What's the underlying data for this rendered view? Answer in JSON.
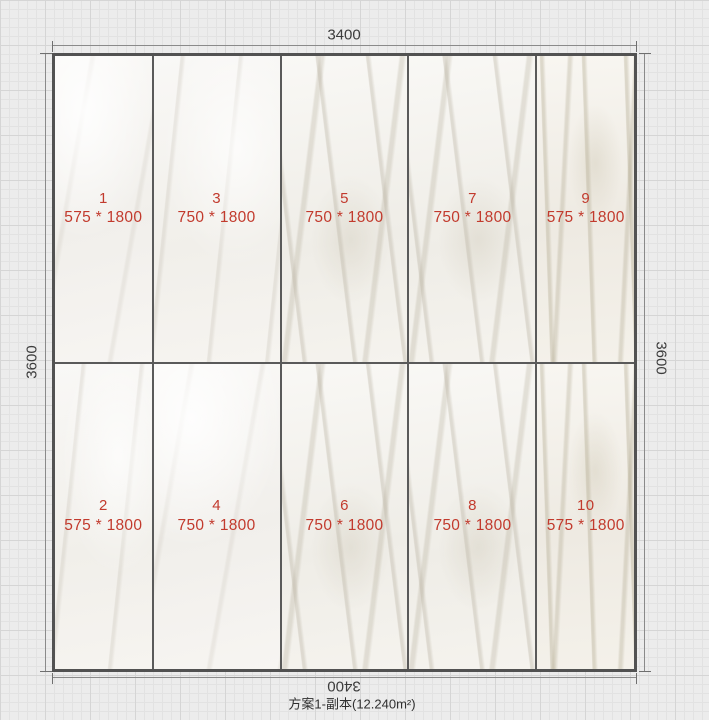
{
  "dimensions": {
    "top": "3400",
    "bottom": "3400",
    "left": "3600",
    "right": "3600"
  },
  "caption": "方案1-副本(12.240m²)",
  "tiles": [
    {
      "num": "1",
      "size": "575 * 1800"
    },
    {
      "num": "3",
      "size": "750 * 1800"
    },
    {
      "num": "5",
      "size": "750 * 1800"
    },
    {
      "num": "7",
      "size": "750 * 1800"
    },
    {
      "num": "9",
      "size": "575 * 1800"
    },
    {
      "num": "2",
      "size": "575 * 1800"
    },
    {
      "num": "4",
      "size": "750 * 1800"
    },
    {
      "num": "6",
      "size": "750 * 1800"
    },
    {
      "num": "8",
      "size": "750 * 1800"
    },
    {
      "num": "10",
      "size": "575 * 1800"
    }
  ],
  "colors": {
    "tile_label_red": "#c23a2d",
    "joint_dark": "#5a5a5a",
    "dim_text": "#3c3c3c",
    "grid_bg": "#ececec"
  }
}
